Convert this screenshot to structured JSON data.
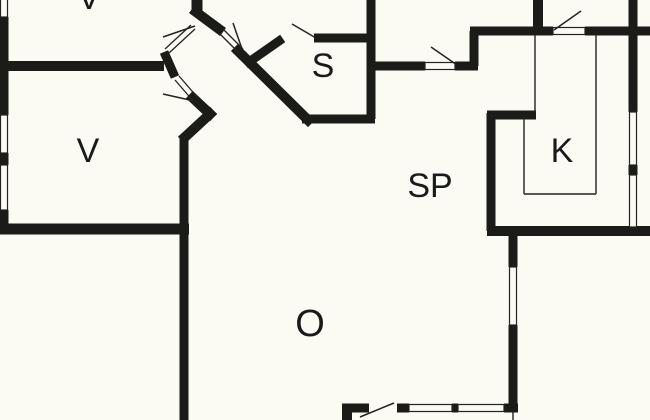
{
  "title": "Holiday home floor plan",
  "canvas": {
    "width": 650,
    "height": 420
  },
  "colors": {
    "background": "#fbfbf4",
    "wall": "#1b1b18",
    "thin": "#23231f",
    "label": "#1a1a1a"
  },
  "rooms": [
    {
      "id": "room-v-top",
      "label": "V",
      "x": 89,
      "y": 9,
      "size": 34
    },
    {
      "id": "room-v",
      "label": "V",
      "x": 88,
      "y": 162,
      "size": 34
    },
    {
      "id": "room-s",
      "label": "S",
      "x": 323,
      "y": 77,
      "size": 34
    },
    {
      "id": "room-sp",
      "label": "SP",
      "x": 430,
      "y": 197,
      "size": 34
    },
    {
      "id": "room-k",
      "label": "K",
      "x": 562,
      "y": 162,
      "size": 34
    },
    {
      "id": "room-o",
      "label": "O",
      "x": 310,
      "y": 336,
      "size": 38
    }
  ],
  "walls": [
    {
      "x1": 4,
      "y1": 17,
      "x2": 4,
      "y2": 115,
      "w": 9
    },
    {
      "x1": 4,
      "y1": 153,
      "x2": 4,
      "y2": 165,
      "w": 9
    },
    {
      "x1": 4,
      "y1": 210,
      "x2": 4,
      "y2": 234,
      "w": 9
    },
    {
      "x1": 0,
      "y1": 66,
      "x2": 164,
      "y2": 66,
      "w": 10
    },
    {
      "x1": 164,
      "y1": 52,
      "x2": 175,
      "y2": 77,
      "w": 9,
      "cap": "butt"
    },
    {
      "x1": 197,
      "y1": 0,
      "x2": 197,
      "y2": 14,
      "w": 11
    },
    {
      "x1": 196,
      "y1": 12,
      "x2": 219,
      "y2": 29,
      "w": 10,
      "cap": "square"
    },
    {
      "x1": 193,
      "y1": 98,
      "x2": 210,
      "y2": 114,
      "w": 10,
      "cap": "square"
    },
    {
      "x1": 210,
      "y1": 114,
      "x2": 185,
      "y2": 137,
      "w": 10,
      "cap": "square"
    },
    {
      "x1": 184,
      "y1": 135,
      "x2": 184,
      "y2": 420,
      "w": 9
    },
    {
      "x1": 0,
      "y1": 229,
      "x2": 189,
      "y2": 229,
      "w": 11
    },
    {
      "x1": 238,
      "y1": 51,
      "x2": 308,
      "y2": 120,
      "w": 10,
      "cap": "square"
    },
    {
      "x1": 302,
      "y1": 119,
      "x2": 375,
      "y2": 119,
      "w": 9
    },
    {
      "x1": 371,
      "y1": 0,
      "x2": 371,
      "y2": 119,
      "w": 9
    },
    {
      "x1": 314,
      "y1": 38,
      "x2": 371,
      "y2": 38,
      "w": 9
    },
    {
      "x1": 249,
      "y1": 62,
      "x2": 279,
      "y2": 41,
      "w": 9,
      "cap": "square"
    },
    {
      "x1": 371,
      "y1": 66,
      "x2": 425,
      "y2": 66,
      "w": 9
    },
    {
      "x1": 455,
      "y1": 66,
      "x2": 478,
      "y2": 66,
      "w": 9
    },
    {
      "x1": 474,
      "y1": 66,
      "x2": 474,
      "y2": 31,
      "w": 9
    },
    {
      "x1": 470,
      "y1": 31,
      "x2": 553,
      "y2": 31,
      "w": 9
    },
    {
      "x1": 538,
      "y1": 0,
      "x2": 538,
      "y2": 33,
      "w": 10
    },
    {
      "x1": 585,
      "y1": 31,
      "x2": 650,
      "y2": 31,
      "w": 9
    },
    {
      "x1": 633,
      "y1": 0,
      "x2": 633,
      "y2": 112,
      "w": 9
    },
    {
      "x1": 633,
      "y1": 165,
      "x2": 633,
      "y2": 175,
      "w": 9
    },
    {
      "x1": 487,
      "y1": 231,
      "x2": 650,
      "y2": 231,
      "w": 10
    },
    {
      "x1": 491,
      "y1": 113,
      "x2": 491,
      "y2": 231,
      "w": 9
    },
    {
      "x1": 487,
      "y1": 115,
      "x2": 536,
      "y2": 115,
      "w": 9
    },
    {
      "x1": 513,
      "y1": 231,
      "x2": 513,
      "y2": 267,
      "w": 9
    },
    {
      "x1": 513,
      "y1": 325,
      "x2": 513,
      "y2": 412,
      "w": 9
    },
    {
      "x1": 504,
      "y1": 408,
      "x2": 518,
      "y2": 408,
      "w": 9
    },
    {
      "x1": 452,
      "y1": 408,
      "x2": 458,
      "y2": 408,
      "w": 9
    },
    {
      "x1": 397,
      "y1": 408,
      "x2": 409,
      "y2": 408,
      "w": 9
    },
    {
      "x1": 342,
      "y1": 408,
      "x2": 369,
      "y2": 408,
      "w": 9
    },
    {
      "x1": 347,
      "y1": 406,
      "x2": 347,
      "y2": 420,
      "w": 10
    }
  ],
  "windows": [
    {
      "x": 0.5,
      "y": -3,
      "w": 7,
      "h": 20
    },
    {
      "x": 0.5,
      "y": 115,
      "w": 7,
      "h": 38
    },
    {
      "x": 0.5,
      "y": 165,
      "w": 7,
      "h": 45
    },
    {
      "x": 629.5,
      "y": 112,
      "w": 7,
      "h": 53
    },
    {
      "x": 629.5,
      "y": 175,
      "w": 7,
      "h": 52
    },
    {
      "x": 509.5,
      "y": 267,
      "w": 7,
      "h": 58
    },
    {
      "x": 409,
      "y": 404.5,
      "w": 43,
      "h": 7
    },
    {
      "x": 458,
      "y": 404.5,
      "w": 46,
      "h": 7
    },
    {
      "x": 553,
      "y": 27.5,
      "w": 32,
      "h": 7
    },
    {
      "x": 425,
      "y": 62.5,
      "w": 30,
      "h": 7
    }
  ],
  "door_leaves": [
    {
      "x1": 554,
      "y1": 30,
      "x2": 581,
      "y2": 11
    },
    {
      "x1": 431,
      "y1": 47,
      "x2": 457,
      "y2": 65
    },
    {
      "x1": 292,
      "y1": 24,
      "x2": 316,
      "y2": 38
    },
    {
      "x1": 360,
      "y1": 417,
      "x2": 394,
      "y2": 403
    },
    {
      "x1": 163,
      "y1": 37,
      "x2": 195,
      "y2": 26
    },
    {
      "x1": 233,
      "y1": 23,
      "x2": 242,
      "y2": 49
    },
    {
      "x1": 163,
      "y1": 94,
      "x2": 194,
      "y2": 101
    }
  ],
  "door_panels": [
    {
      "x1": 165,
      "y1": 49,
      "x2": 191,
      "y2": 25
    },
    {
      "x1": 169,
      "y1": 53,
      "x2": 195,
      "y2": 29
    },
    {
      "x1": 219,
      "y1": 33,
      "x2": 239,
      "y2": 53
    },
    {
      "x1": 223,
      "y1": 29,
      "x2": 243,
      "y2": 49
    },
    {
      "x1": 175,
      "y1": 80,
      "x2": 194,
      "y2": 102
    },
    {
      "x1": 179,
      "y1": 76,
      "x2": 198,
      "y2": 98
    }
  ],
  "fixtures": [
    {
      "x1": 596,
      "y1": 35,
      "x2": 596,
      "y2": 194
    },
    {
      "x1": 524,
      "y1": 194,
      "x2": 596,
      "y2": 194
    },
    {
      "x1": 524,
      "y1": 118,
      "x2": 524,
      "y2": 194
    },
    {
      "x1": 535,
      "y1": 35,
      "x2": 535,
      "y2": 112
    },
    {
      "x1": 513,
      "y1": 412,
      "x2": 513,
      "y2": 420
    }
  ]
}
